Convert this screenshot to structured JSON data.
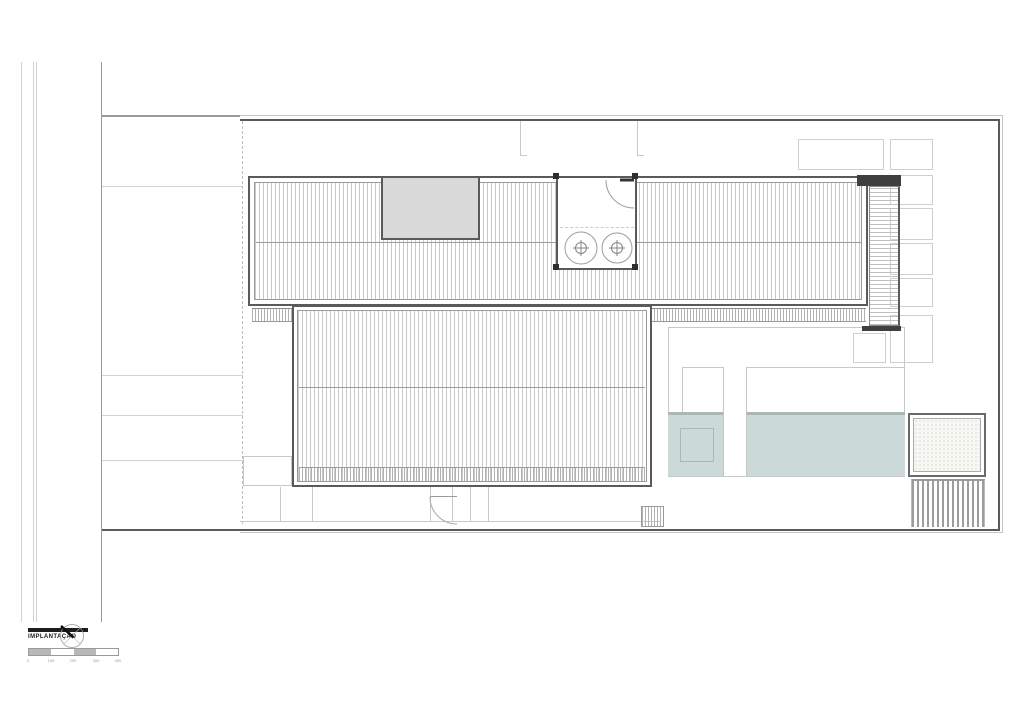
{
  "legend": {
    "title": "IMPLANTAÇÃO",
    "north_arrow_icon": "north-arrow-icon",
    "scale_ticks": [
      "0",
      "100",
      "200",
      "300",
      "400"
    ]
  },
  "colors": {
    "paper": "#ffffff",
    "pool": "#cbd9d8",
    "pool_edge": "#a9b8b7",
    "courtyard_fill": "#d9d9d9",
    "wall_dark": "#3f3f3f",
    "line_dark": "#5a5a5a",
    "line_mid": "#9a9a9a",
    "line_light": "#c9c9c9",
    "hatch": "#c9c9c9"
  }
}
